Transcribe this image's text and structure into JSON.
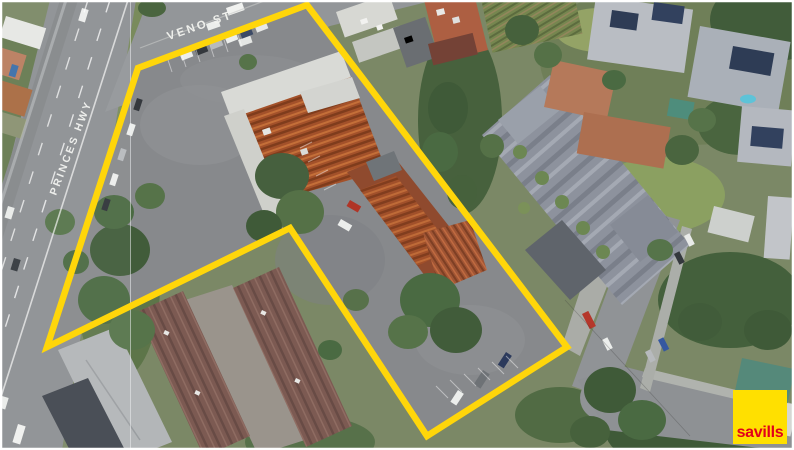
{
  "image": {
    "description": "Aerial drone photograph of a commercial shopping-strip property marketed for sale, with yellow site boundary outline",
    "frame_color": "#ffffff"
  },
  "street_labels": {
    "veno_st": "VENO ST",
    "princes_hwy": "PRINCES HWY"
  },
  "boundary": {
    "color": "#ffd60a"
  },
  "logo": {
    "text": "savills",
    "background_color": "#ffe000",
    "text_color": "#e2001a"
  }
}
